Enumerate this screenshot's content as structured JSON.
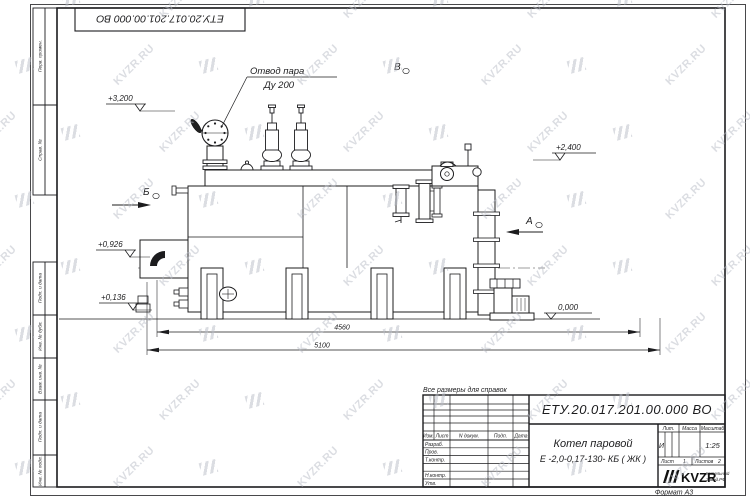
{
  "watermark": {
    "text": "KVZR.RU"
  },
  "frame": {
    "top_doc_number": "ЕТУ.20.017.201.00.000  ВО",
    "format_label": "Формат А3",
    "side_labels": [
      "Перв. примен.",
      "Справ. №",
      "Подп. и дата",
      "Инв. № дубл.",
      "Взам. инв. №",
      "Подп. и дата",
      "Инв. № подл."
    ]
  },
  "notes": {
    "reference": "Все размеры для справок"
  },
  "drawing": {
    "callout_line1": "Отвод пара",
    "callout_line2": "Ду 200",
    "elev_3200": "+3,200",
    "elev_2400": "+2,400",
    "elev_0926": "+0,926",
    "elev_0136": "+0,136",
    "elev_0000": "0,000",
    "dim_4560": "4560",
    "dim_5100": "5100",
    "view_b": "Б",
    "view_a": "А",
    "view_v": "В"
  },
  "title_block": {
    "doc_number": "ЕТУ.20.017.201.00.000  ВО",
    "name_line1": "Котел паровой",
    "name_line2": "Е -2,0-0,17-130- КБ ( ЖК )",
    "col_izm": "Изм.",
    "col_list": "Лист",
    "col_ndoc": "N докум.",
    "col_podp": "Подп.",
    "col_data": "Дата",
    "row_razrab": "Разраб.",
    "row_prov": "Пров.",
    "row_tkontr": "Т.контр.",
    "row_nkontr": "Н.контр.",
    "row_utv": "Утв.",
    "lit_header": "Лит.",
    "mass_header": "Масса",
    "scale_header": "Масштаб",
    "lit_value": "И",
    "scale_value": "1:25",
    "list_label": "Лист",
    "list_value": "1",
    "listov_label": "Листов",
    "listov_value": "2",
    "logo_text": "KVZR",
    "company_line1": "Котельный",
    "company_line2": "Завод.РФ",
    "line_color": "#1c1c1e"
  }
}
